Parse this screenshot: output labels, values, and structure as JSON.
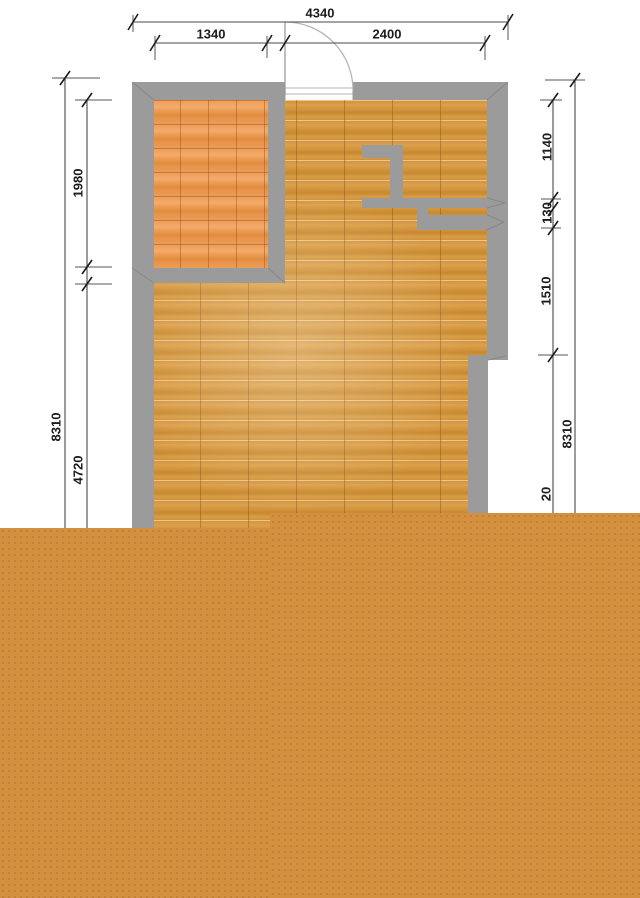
{
  "plan": {
    "dimensions": {
      "top": {
        "total": "4340",
        "left_segment": "1340",
        "right_segment": "2400"
      },
      "left": {
        "room_depth": "1980",
        "total": "8310",
        "lower": "4720"
      },
      "right": {
        "upper": "1140",
        "niche": "130",
        "mid": "1510",
        "total": "8310",
        "lower_clipped": "20"
      }
    },
    "colors": {
      "wall_gray": "#9b9b9b",
      "main_floor_wood": "#d2943e",
      "side_room_wood": "#e6944d",
      "unrendered_fill": "#d39140",
      "dimension_lines": "#4a4a4a",
      "background": "#ffffff"
    }
  }
}
